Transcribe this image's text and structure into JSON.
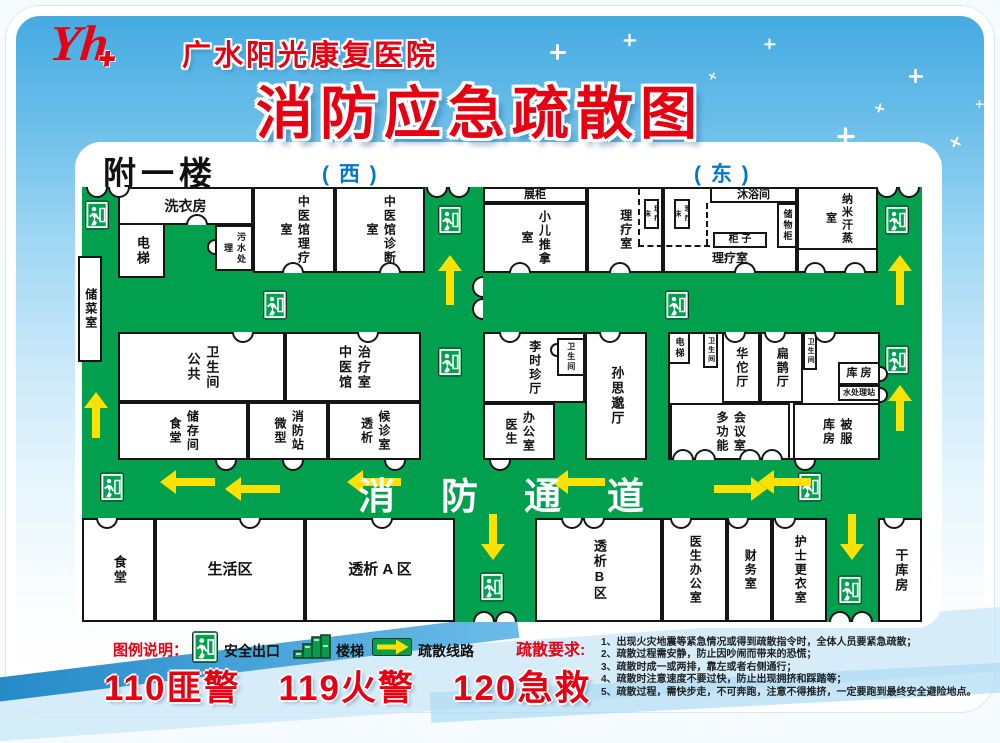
{
  "header": {
    "logo_text": "Yh",
    "hospital_name": "广水阳光康复医院",
    "title": "消防应急疏散图"
  },
  "floor": {
    "name": "附一楼",
    "west_label": "( 西 )",
    "east_label": "( 东 )",
    "corridor_text": "消防通道"
  },
  "colors": {
    "corridor_green": "#00a04e",
    "arrow_yellow": "#ffe100",
    "accent_red": "#e60012",
    "direction_blue": "#0077c8",
    "sky_blue": "#45abe2"
  },
  "map": {
    "rooms": [
      {
        "id": "laundry",
        "label": "洗衣房",
        "x": 36,
        "y": 7,
        "w": 135,
        "h": 38,
        "dir": "h",
        "fs": 14
      },
      {
        "id": "elevator-west",
        "label": "电梯",
        "x": 36,
        "y": 43,
        "w": 47,
        "h": 55,
        "dir": "v",
        "fs": 13
      },
      {
        "id": "sewage-treatment",
        "label": "污水处理",
        "x": 133,
        "y": 45,
        "w": 38,
        "h": 46,
        "dir": "v",
        "fs": 9
      },
      {
        "id": "tcm-physio-room",
        "label": "中医馆理疗室",
        "x": 171,
        "y": 7,
        "w": 82,
        "h": 86,
        "dir": "v",
        "fs": 12
      },
      {
        "id": "tcm-diagnosis-room",
        "label": "中医馆诊断室",
        "x": 253,
        "y": 7,
        "w": 90,
        "h": 86,
        "dir": "v",
        "fs": 12
      },
      {
        "id": "display-cabinet",
        "label": "展柜",
        "x": 401,
        "y": 7,
        "w": 104,
        "h": 16,
        "dir": "h",
        "fs": 11
      },
      {
        "id": "pediatric-massage-room",
        "label": "小儿推拿室",
        "x": 401,
        "y": 23,
        "w": 104,
        "h": 70,
        "dir": "v",
        "fs": 12
      },
      {
        "id": "physio-room-west",
        "label": "理疗室",
        "x": 505,
        "y": 7,
        "w": 76,
        "h": 86,
        "dir": "v",
        "fs": 12
      },
      {
        "id": "physio-room-east",
        "label": "理疗室",
        "x": 581,
        "y": 7,
        "w": 134,
        "h": 86,
        "dir": "h",
        "fs": 12,
        "cls": "lb"
      },
      {
        "id": "shower-room",
        "label": "沐浴间",
        "x": 628,
        "y": 7,
        "w": 87,
        "h": 16,
        "dir": "h",
        "fs": 11
      },
      {
        "id": "locker-cabinet",
        "label": "储物柜",
        "x": 695,
        "y": 23,
        "w": 20,
        "h": 45,
        "dir": "v",
        "fs": 9
      },
      {
        "id": "cabinet",
        "label": "柜 子",
        "x": 631,
        "y": 52,
        "w": 54,
        "h": 16,
        "dir": "h",
        "fs": 10
      },
      {
        "id": "physio-bed-1",
        "label": "理疗床",
        "x": 562,
        "y": 19,
        "w": 15,
        "h": 30,
        "dir": "v",
        "fs": 7
      },
      {
        "id": "physio-bed-2",
        "label": "理疗床",
        "x": 592,
        "y": 19,
        "w": 16,
        "h": 30,
        "dir": "v",
        "fs": 7
      },
      {
        "id": "nano-steam-room",
        "label": "纳米汗蒸室",
        "x": 715,
        "y": 7,
        "w": 81,
        "h": 63,
        "dir": "v",
        "fs": 11
      },
      {
        "id": "nano-annex",
        "label": "",
        "x": 715,
        "y": 68,
        "w": 81,
        "h": 25
      },
      {
        "id": "veg-storage",
        "label": "储菜室",
        "x": -4,
        "y": 76,
        "w": 24,
        "h": 106,
        "dir": "v",
        "fs": 12
      },
      {
        "id": "public-restroom",
        "label": "卫生间\n公共",
        "x": 36,
        "y": 152,
        "w": 167,
        "h": 70,
        "dir": "v",
        "fs": 13
      },
      {
        "id": "tcm-treatment-room",
        "label": "治疗室\n中医馆",
        "x": 203,
        "y": 152,
        "w": 136,
        "h": 70,
        "dir": "v",
        "fs": 13
      },
      {
        "id": "canteen-storage",
        "label": "储存间\n食堂",
        "x": 36,
        "y": 222,
        "w": 130,
        "h": 58,
        "dir": "v",
        "fs": 12
      },
      {
        "id": "mini-fire-station",
        "label": "消防站\n微型",
        "x": 166,
        "y": 222,
        "w": 80,
        "h": 58,
        "dir": "v",
        "fs": 12
      },
      {
        "id": "dialysis-waiting",
        "label": "候诊室\n透析",
        "x": 246,
        "y": 222,
        "w": 93,
        "h": 58,
        "dir": "v",
        "fs": 12
      },
      {
        "id": "lishizhen-hall",
        "label": "李时珍厅",
        "x": 401,
        "y": 152,
        "w": 102,
        "h": 71,
        "dir": "v",
        "fs": 12
      },
      {
        "id": "restroom-center",
        "label": "卫生间",
        "x": 475,
        "y": 158,
        "w": 28,
        "h": 38,
        "dir": "v",
        "fs": 8
      },
      {
        "id": "sunsimiao-hall",
        "label": "孙思邈厅",
        "x": 503,
        "y": 152,
        "w": 62,
        "h": 128,
        "dir": "v",
        "fs": 13
      },
      {
        "id": "doctor-office-mid",
        "label": "办公室\n医生",
        "x": 401,
        "y": 223,
        "w": 72,
        "h": 57,
        "dir": "v",
        "fs": 12
      },
      {
        "id": "east-block",
        "label": "",
        "x": 586,
        "y": 152,
        "w": 212,
        "h": 128
      },
      {
        "id": "elevator-east",
        "label": "电梯",
        "x": 586,
        "y": 152,
        "w": 22,
        "h": 32,
        "dir": "v",
        "fs": 9
      },
      {
        "id": "restroom-east-1",
        "label": "卫生间",
        "x": 621,
        "y": 152,
        "w": 15,
        "h": 36,
        "dir": "v",
        "fs": 7
      },
      {
        "id": "huatuo-hall",
        "label": "华佗厅",
        "x": 640,
        "y": 152,
        "w": 38,
        "h": 71,
        "dir": "v",
        "fs": 12
      },
      {
        "id": "bianque-hall",
        "label": "扁鹊厅",
        "x": 678,
        "y": 152,
        "w": 43,
        "h": 71,
        "dir": "v",
        "fs": 12
      },
      {
        "id": "restroom-east-2",
        "label": "卫生间",
        "x": 721,
        "y": 152,
        "w": 14,
        "h": 38,
        "dir": "v",
        "fs": 7
      },
      {
        "id": "storeroom",
        "label": "库 房",
        "x": 756,
        "y": 182,
        "w": 42,
        "h": 23,
        "dir": "h",
        "fs": 11
      },
      {
        "id": "water-treatment-station",
        "label": "水处理站",
        "x": 756,
        "y": 205,
        "w": 42,
        "h": 16,
        "dir": "h",
        "fs": 8
      },
      {
        "id": "multifunction-meeting-room",
        "label": "会议室\n多功能",
        "x": 588,
        "y": 223,
        "w": 120,
        "h": 57,
        "dir": "v",
        "fs": 12
      },
      {
        "id": "linen-storeroom",
        "label": "被服\n库房",
        "x": 711,
        "y": 223,
        "w": 87,
        "h": 57,
        "dir": "v",
        "fs": 12
      },
      {
        "id": "canteen-south",
        "label": "食堂",
        "x": 0,
        "y": 338,
        "w": 73,
        "h": 104,
        "dir": "v",
        "fs": 13
      },
      {
        "id": "living-area",
        "label": "生活区",
        "x": 73,
        "y": 338,
        "w": 150,
        "h": 104,
        "dir": "h",
        "fs": 15
      },
      {
        "id": "dialysis-area-a",
        "label": "透析 A 区",
        "x": 223,
        "y": 338,
        "w": 150,
        "h": 104,
        "dir": "h",
        "fs": 15
      },
      {
        "id": "dialysis-area-b",
        "label": "透析B区",
        "x": 453,
        "y": 338,
        "w": 127,
        "h": 104,
        "dir": "v",
        "fs": 13
      },
      {
        "id": "doctor-office-south",
        "label": "医生办公室",
        "x": 580,
        "y": 338,
        "w": 65,
        "h": 104,
        "dir": "v",
        "fs": 12
      },
      {
        "id": "finance-office",
        "label": "财务室",
        "x": 645,
        "y": 338,
        "w": 45,
        "h": 104,
        "dir": "v",
        "fs": 12
      },
      {
        "id": "nurse-changing-room",
        "label": "护士更衣室",
        "x": 690,
        "y": 338,
        "w": 55,
        "h": 104,
        "dir": "v",
        "fs": 12
      },
      {
        "id": "dry-storeroom",
        "label": "干库房",
        "x": 796,
        "y": 338,
        "w": 44,
        "h": 104,
        "dir": "v",
        "fs": 13
      }
    ],
    "partitions": [
      {
        "cls": "dashv",
        "x": 556,
        "y": 9,
        "w": 0,
        "h": 56
      },
      {
        "cls": "dashh",
        "x": 556,
        "y": 65,
        "w": 72,
        "h": 0
      },
      {
        "cls": "dashv",
        "x": 624,
        "y": 23,
        "w": 0,
        "h": 42
      }
    ],
    "exits": [
      {
        "x": 3,
        "y": 20
      },
      {
        "x": 356,
        "y": 25
      },
      {
        "x": 803,
        "y": 25
      },
      {
        "x": 181,
        "y": 110
      },
      {
        "x": 583,
        "y": 110
      },
      {
        "x": 356,
        "y": 167
      },
      {
        "x": 803,
        "y": 165
      },
      {
        "x": 18,
        "y": 292
      },
      {
        "x": 716,
        "y": 292
      },
      {
        "x": 398,
        "y": 392
      },
      {
        "x": 756,
        "y": 395
      }
    ],
    "arrows": [
      {
        "cx": 106,
        "cy": 302,
        "len": 57,
        "dir": "left"
      },
      {
        "cx": 293,
        "cy": 302,
        "len": 56,
        "dir": "left"
      },
      {
        "cx": 497,
        "cy": 302,
        "len": 55,
        "dir": "left"
      },
      {
        "cx": 703,
        "cy": 302,
        "len": 55,
        "dir": "left"
      },
      {
        "cx": 368,
        "cy": 101,
        "len": 52,
        "dir": "up"
      },
      {
        "cx": 818,
        "cy": 101,
        "len": 52,
        "dir": "up"
      },
      {
        "cx": 14,
        "cy": 236,
        "len": 48,
        "dir": "up"
      },
      {
        "cx": 818,
        "cy": 229,
        "len": 48,
        "dir": "up"
      },
      {
        "cx": 171,
        "cy": 309,
        "len": 57,
        "dir": "left"
      },
      {
        "cx": 657,
        "cy": 309,
        "len": 55,
        "dir": "right"
      },
      {
        "cx": 411,
        "cy": 356,
        "len": 48,
        "dir": "down"
      },
      {
        "cx": 770,
        "cy": 356,
        "len": 48,
        "dir": "down"
      }
    ],
    "doors": [
      {
        "x": 26,
        "y": 7,
        "o": "down",
        "double": 1
      },
      {
        "x": 366,
        "y": 7,
        "o": "down",
        "double": 1
      },
      {
        "x": 816,
        "y": 7,
        "o": "down",
        "double": 1
      },
      {
        "x": 401,
        "y": 118,
        "o": "left",
        "double": 1
      },
      {
        "x": 612,
        "y": 280,
        "o": "up",
        "double": 1
      },
      {
        "x": 679,
        "y": 280,
        "o": "up",
        "double": 1
      },
      {
        "x": 413,
        "y": 442,
        "o": "up",
        "double": 1
      },
      {
        "x": 769,
        "y": 442,
        "o": "up",
        "double": 1
      },
      {
        "x": 501,
        "y": 338,
        "o": "down",
        "double": 1
      },
      {
        "x": 115,
        "y": 45,
        "o": "up"
      },
      {
        "x": 133,
        "y": 67,
        "o": "left",
        "r": 8
      },
      {
        "x": 211,
        "y": 93,
        "o": "up"
      },
      {
        "x": 308,
        "y": 93,
        "o": "up"
      },
      {
        "x": 438,
        "y": 93,
        "o": "up"
      },
      {
        "x": 538,
        "y": 93,
        "o": "up"
      },
      {
        "x": 663,
        "y": 93,
        "o": "up"
      },
      {
        "x": 733,
        "y": 93,
        "o": "up"
      },
      {
        "x": 773,
        "y": 93,
        "o": "up"
      },
      {
        "x": 161,
        "y": 152,
        "o": "down"
      },
      {
        "x": 286,
        "y": 152,
        "o": "down"
      },
      {
        "x": 428,
        "y": 152,
        "o": "down"
      },
      {
        "x": 528,
        "y": 152,
        "o": "down"
      },
      {
        "x": 653,
        "y": 152,
        "o": "down"
      },
      {
        "x": 693,
        "y": 152,
        "o": "down"
      },
      {
        "x": 743,
        "y": 152,
        "o": "down"
      },
      {
        "x": 798,
        "y": 194,
        "o": "right",
        "r": 8
      },
      {
        "x": 798,
        "y": 215,
        "o": "right",
        "r": 8
      },
      {
        "x": 475,
        "y": 170,
        "o": "left",
        "r": 7
      },
      {
        "x": 144,
        "y": 280,
        "o": "down"
      },
      {
        "x": 211,
        "y": 280,
        "o": "down"
      },
      {
        "x": 313,
        "y": 280,
        "o": "down"
      },
      {
        "x": 418,
        "y": 280,
        "o": "down"
      },
      {
        "x": 723,
        "y": 280,
        "o": "down"
      },
      {
        "x": 25,
        "y": 338,
        "o": "down"
      },
      {
        "x": 168,
        "y": 338,
        "o": "down"
      },
      {
        "x": 300,
        "y": 338,
        "o": "down"
      },
      {
        "x": 599,
        "y": 338,
        "o": "down"
      },
      {
        "x": 656,
        "y": 338,
        "o": "down"
      },
      {
        "x": 703,
        "y": 338,
        "o": "down"
      },
      {
        "x": 812,
        "y": 338,
        "o": "down"
      }
    ]
  },
  "legend": {
    "label": "图例说明：",
    "items": [
      {
        "icon": "exit-sign-icon",
        "label": "安全出口"
      },
      {
        "icon": "stairs-icon",
        "label": "楼梯"
      },
      {
        "icon": "route-arrow-icon",
        "label": "疏散线路"
      }
    ]
  },
  "emergency_numbers": [
    "110匪警",
    "119火警",
    "120急救"
  ],
  "requirements": {
    "label": "疏散要求:",
    "items": [
      "1、出现火灾地震等紧急情况或得到疏散指令时，全体人员要紧急疏散；",
      "2、疏散过程需安静，防止因吵闹而带来的恐慌；",
      "3、疏散时成一或两排，靠左或者右侧通行；",
      "4、疏散时注意速度不要过快，防止出现拥挤和踩踏等；",
      "5、疏散过程，需快步走，不可奔跑，注意不得推挤，一定要跑到最终安全避险地点。"
    ]
  }
}
